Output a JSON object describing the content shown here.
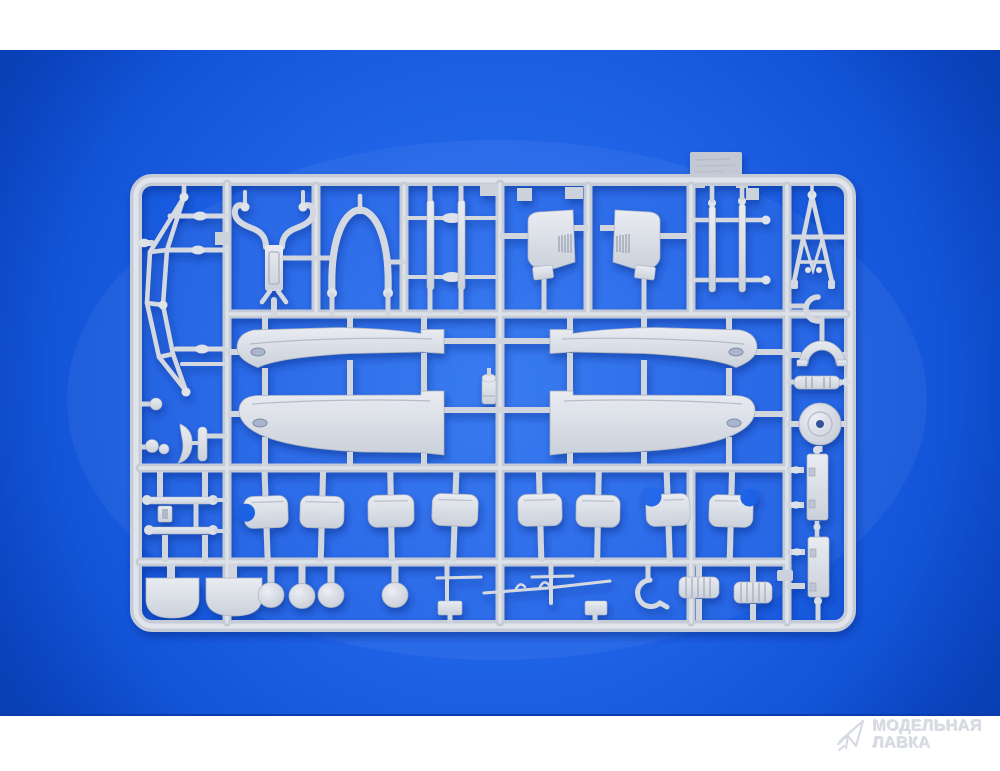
{
  "page": {
    "background": "#ffffff"
  },
  "photo": {
    "background_center": "#2f74f0",
    "background_mid": "#1d60e4",
    "background_edge": "#0b4bce",
    "divider_line": "#0a3cae"
  },
  "sprue": {
    "plastic_light": "#e9ecf1",
    "plastic_base": "#cbd1db",
    "plastic_runner_edge": "#c4cad6",
    "plastic_runner_core": "#dde2e9",
    "plastic_gate": "#d0d5de",
    "plastic_dark": "#9ea7b6",
    "shadow_color": "#03257a"
  },
  "watermark": {
    "line1": "МОДЕЛЬНАЯ",
    "line2": "ЛАВКА",
    "color": "#d6dae1",
    "logo": "paper-plane"
  }
}
